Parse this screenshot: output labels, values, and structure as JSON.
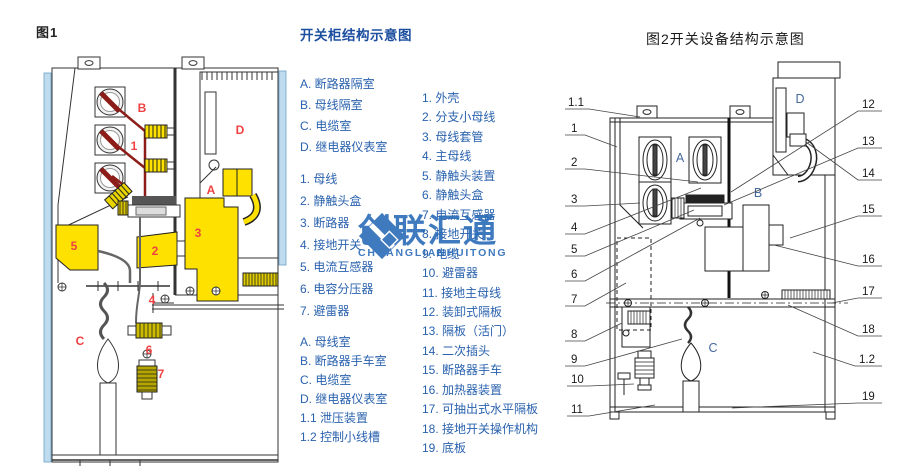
{
  "fig1": {
    "caption": "图1",
    "labels": [
      "B",
      "1",
      "D",
      "A",
      "3",
      "5",
      "2",
      "4",
      "C",
      "6",
      "7"
    ]
  },
  "legend1": {
    "title": "开关柜结构示意图",
    "rooms": [
      "A. 断路器隔室",
      "B. 母线隔室",
      "C. 电缆室",
      "D. 继电器仪表室"
    ],
    "parts": [
      "1. 母线",
      "2. 静触头盒",
      "3. 断路器",
      "4. 接地开关",
      "5. 电流互感器",
      "6. 电容分压器",
      "7. 避雷器"
    ],
    "rooms2": [
      "A. 母线室",
      "B. 断路器手车室",
      "C. 电缆室",
      "D. 继电器仪表室",
      "1.1 泄压装置",
      "1.2 控制小线槽"
    ]
  },
  "legend2": {
    "items": [
      "1. 外壳",
      "2. 分支小母线",
      "3. 母线套管",
      "4. 主母线",
      "5. 静触头装置",
      "6. 静触头盒",
      "7. 电流互感器",
      "8. 接地开关",
      "9. 电缆",
      "10. 避雷器",
      "11. 接地主母线",
      "12. 装卸式隔板",
      "13. 隔板（活门）",
      "14. 二次插头",
      "15. 断路器手车",
      "16. 加热器装置",
      "17. 可抽出式水平隔板",
      "18. 接地开关操作机构",
      "19. 底板"
    ]
  },
  "fig2": {
    "title": "图2开关设备结构示意图",
    "letters": [
      "A",
      "B",
      "C",
      "D"
    ],
    "callouts_left": [
      "1.1",
      "1",
      "2",
      "3",
      "4",
      "5",
      "6",
      "7",
      "8",
      "9",
      "10",
      "11"
    ],
    "callouts_right": [
      "12",
      "13",
      "14",
      "15",
      "16",
      "17",
      "18",
      "1.2",
      "19"
    ]
  },
  "watermark": {
    "text": "创联汇通",
    "subtext": "CHUANGLIANHUITONG"
  },
  "colors": {
    "legend_text": "#2a62ae",
    "legend_title": "#1d4fa0",
    "fig1_label_red": "#ef4143",
    "fig2_letter_blue": "#44699d",
    "watermark_blue": "#2b6cb8",
    "component_yellow": "#ffe100",
    "busbar_red": "#8c1d18",
    "wall_blue": "#bfdcee"
  }
}
